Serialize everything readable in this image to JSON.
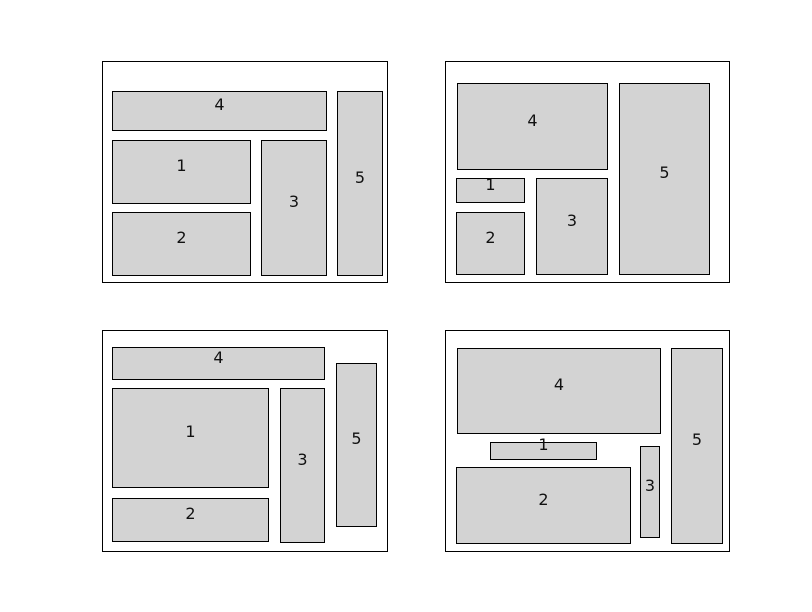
{
  "figure": {
    "width": 812,
    "height": 612,
    "background": "#ffffff",
    "description": "Four panels, each showing a rectangle-packing layout of five numbered boxes inside an outlined frame"
  },
  "style": {
    "box_fill": "#d3d3d3",
    "box_border": "#000000",
    "frame_border": "#000000",
    "frame_fill": "#ffffff",
    "label_color": "#111111"
  },
  "panels": [
    {
      "id": "top-left",
      "frame": {
        "x": 102,
        "y": 61,
        "w": 286,
        "h": 222
      },
      "boxes": [
        {
          "label": "4",
          "x": 112,
          "y": 91,
          "w": 215,
          "h": 40
        },
        {
          "label": "1",
          "x": 112,
          "y": 140,
          "w": 139,
          "h": 64
        },
        {
          "label": "2",
          "x": 112,
          "y": 212,
          "w": 139,
          "h": 64
        },
        {
          "label": "3",
          "x": 261,
          "y": 140,
          "w": 66,
          "h": 136
        },
        {
          "label": "5",
          "x": 337,
          "y": 91,
          "w": 46,
          "h": 185
        }
      ]
    },
    {
      "id": "top-right",
      "frame": {
        "x": 445,
        "y": 61,
        "w": 285,
        "h": 222
      },
      "boxes": [
        {
          "label": "4",
          "x": 457,
          "y": 83,
          "w": 151,
          "h": 87
        },
        {
          "label": "1",
          "x": 456,
          "y": 178,
          "w": 69,
          "h": 25
        },
        {
          "label": "2",
          "x": 456,
          "y": 212,
          "w": 69,
          "h": 63
        },
        {
          "label": "3",
          "x": 536,
          "y": 178,
          "w": 72,
          "h": 97
        },
        {
          "label": "5",
          "x": 619,
          "y": 83,
          "w": 91,
          "h": 192
        }
      ]
    },
    {
      "id": "bottom-left",
      "frame": {
        "x": 102,
        "y": 330,
        "w": 286,
        "h": 222
      },
      "boxes": [
        {
          "label": "4",
          "x": 112,
          "y": 347,
          "w": 213,
          "h": 33
        },
        {
          "label": "1",
          "x": 112,
          "y": 388,
          "w": 157,
          "h": 100
        },
        {
          "label": "2",
          "x": 112,
          "y": 498,
          "w": 157,
          "h": 44
        },
        {
          "label": "3",
          "x": 280,
          "y": 388,
          "w": 45,
          "h": 155
        },
        {
          "label": "5",
          "x": 336,
          "y": 363,
          "w": 41,
          "h": 164
        }
      ]
    },
    {
      "id": "bottom-right",
      "frame": {
        "x": 445,
        "y": 330,
        "w": 285,
        "h": 222
      },
      "boxes": [
        {
          "label": "4",
          "x": 457,
          "y": 348,
          "w": 204,
          "h": 86
        },
        {
          "label": "1",
          "x": 490,
          "y": 442,
          "w": 107,
          "h": 18
        },
        {
          "label": "2",
          "x": 456,
          "y": 467,
          "w": 175,
          "h": 77
        },
        {
          "label": "3",
          "x": 640,
          "y": 446,
          "w": 20,
          "h": 92
        },
        {
          "label": "5",
          "x": 671,
          "y": 348,
          "w": 52,
          "h": 196
        }
      ]
    }
  ]
}
